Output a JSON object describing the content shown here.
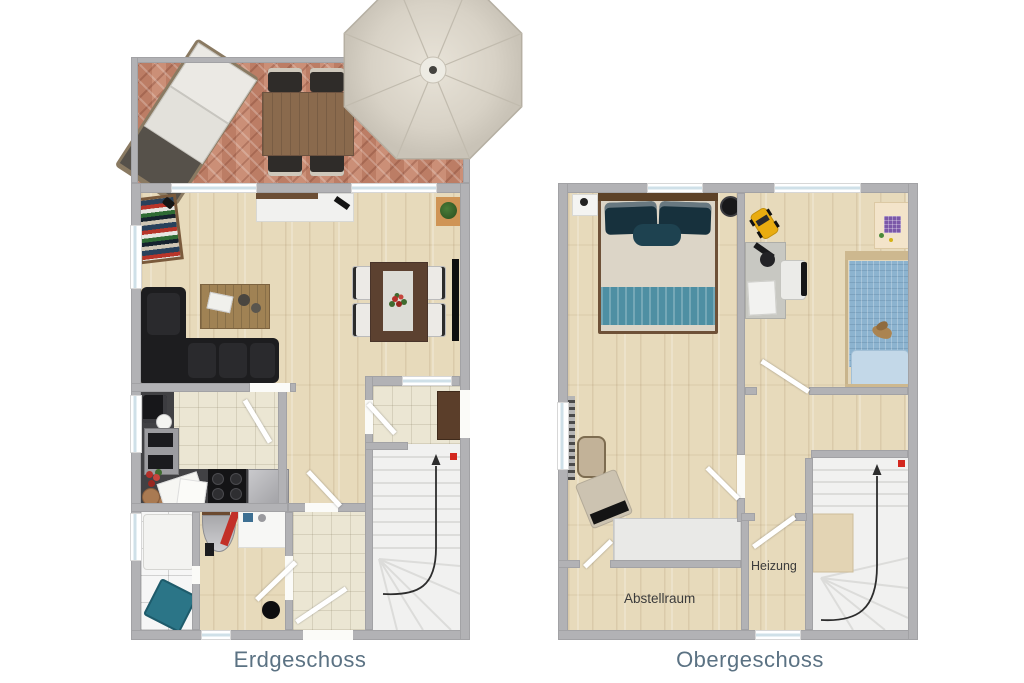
{
  "floor_plans": {
    "ground": {
      "label": "Erdgeschoss"
    },
    "upper": {
      "label": "Obergeschoss",
      "rooms": {
        "heating": "Heizung",
        "storage": "Abstellraum"
      }
    }
  },
  "colors": {
    "plan_label_text": "#5b7283",
    "room_label_text": "#3b3b3b",
    "wall_gray": "#b2b2b5",
    "wood_floor": "#e7dabb",
    "tile_beige": "#ebe6d3",
    "tile_white": "#f6f6f6",
    "terrace_brick": "#c48970",
    "stairs_white": "#f1f1f0",
    "sofa_black": "#1d1d1f",
    "bed_teal": "#4e8fa3",
    "kids_blanket_blue": "#8cb3cf",
    "parasol_cream": "#d8d2c6",
    "stair_marker_red": "#d3271e",
    "laundry_basket_teal": "#2b7587",
    "doormat_brown": "#5b3e2a"
  }
}
